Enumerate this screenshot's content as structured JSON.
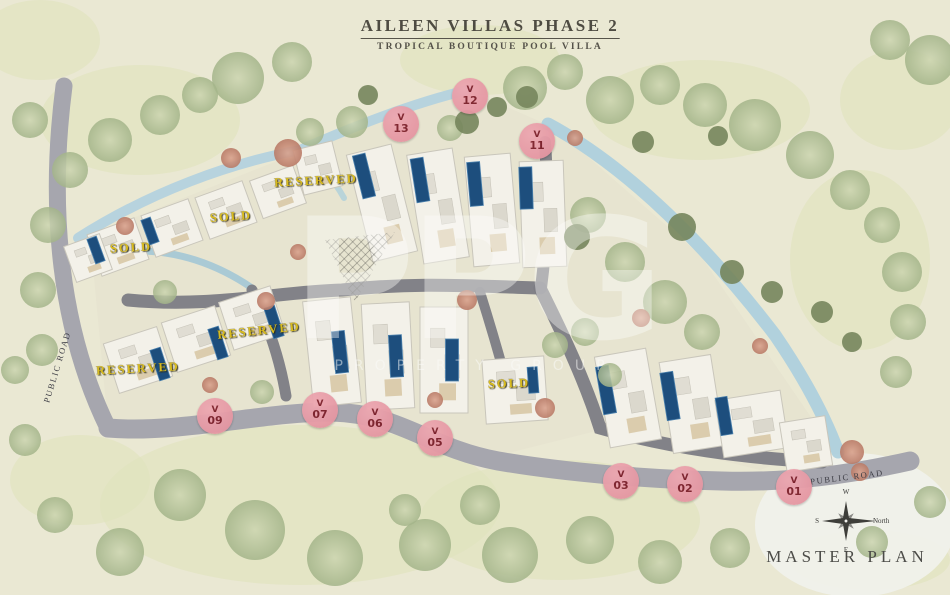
{
  "title": {
    "main": "AILEEN VILLAS PHASE 2",
    "subtitle": "TROPICAL BOUTIQUE POOL VILLA"
  },
  "watermark": {
    "text": "PPG",
    "subtext": "PROPERTY GROUP"
  },
  "masterplan_label": "MASTER PLAN",
  "compass": {
    "top": "W",
    "right": "North",
    "bottom": "E",
    "left": "S"
  },
  "road_labels": [
    {
      "text": "PUBLIC ROAD",
      "x": 57,
      "y": 367,
      "rotation": -73
    },
    {
      "text": "PUBLIC ROAD",
      "x": 847,
      "y": 477,
      "rotation": -7
    }
  ],
  "status_labels": [
    {
      "text": "RESERVED",
      "x": 316,
      "y": 181,
      "rotation": -3
    },
    {
      "text": "SOLD",
      "x": 231,
      "y": 217,
      "rotation": -4
    },
    {
      "text": "SOLD",
      "x": 131,
      "y": 248,
      "rotation": -3
    },
    {
      "text": "RESERVED",
      "x": 259,
      "y": 331,
      "rotation": -6
    },
    {
      "text": "RESERVED",
      "x": 138,
      "y": 369,
      "rotation": -3
    },
    {
      "text": "SOLD",
      "x": 509,
      "y": 384,
      "rotation": -2
    }
  ],
  "villa_markers": [
    {
      "prefix": "V",
      "number": "13",
      "x": 401,
      "y": 124
    },
    {
      "prefix": "V",
      "number": "12",
      "x": 470,
      "y": 96
    },
    {
      "prefix": "V",
      "number": "11",
      "x": 537,
      "y": 141
    },
    {
      "prefix": "V",
      "number": "09",
      "x": 215,
      "y": 416
    },
    {
      "prefix": "V",
      "number": "07",
      "x": 320,
      "y": 410
    },
    {
      "prefix": "V",
      "number": "06",
      "x": 375,
      "y": 419
    },
    {
      "prefix": "V",
      "number": "05",
      "x": 435,
      "y": 438
    },
    {
      "prefix": "V",
      "number": "03",
      "x": 621,
      "y": 481
    },
    {
      "prefix": "V",
      "number": "02",
      "x": 685,
      "y": 484
    },
    {
      "prefix": "V",
      "number": "01",
      "x": 794,
      "y": 487
    }
  ],
  "colors": {
    "marker_bg": "#e2919d",
    "marker_text": "#7c1f2a",
    "status_text": "#d8bb1f",
    "pool": "#1d4e7d",
    "water": "#aed0dd",
    "road_outer": "#a6a6ae",
    "road_inner": "#7c7c84",
    "title_text": "#4e4b42"
  }
}
